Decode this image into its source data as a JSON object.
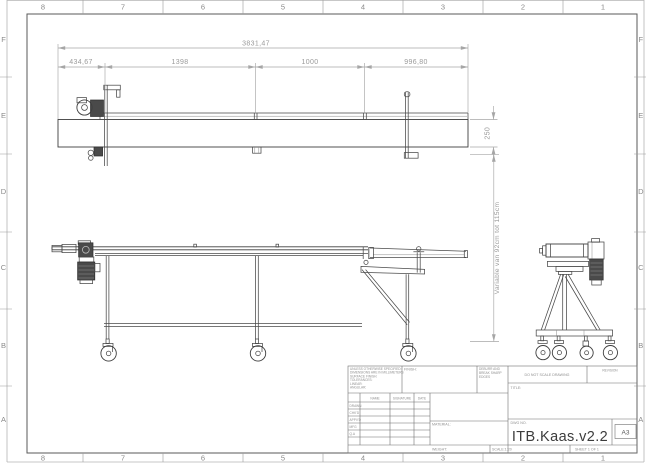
{
  "sheet": {
    "paper_size": "A3"
  },
  "grid": {
    "cols": [
      "8",
      "7",
      "6",
      "5",
      "4",
      "3",
      "2",
      "1"
    ],
    "rows": [
      "F",
      "E",
      "D",
      "C",
      "B",
      "A"
    ]
  },
  "dimensions": {
    "overall_length": "3831,47",
    "segment_1": "434,67",
    "segment_2": "1398",
    "segment_3": "1000",
    "segment_4": "996,80",
    "belt_section_height": "250",
    "height_note": "Variable van 92cm tot 115cm"
  },
  "title_block": {
    "tolerance_note_lines": [
      "UNLESS OTHERWISE SPECIFIED:",
      "DIMENSIONS ARE IN MILLIMETERS",
      "SURFACE FINISH:",
      "TOLERANCES:",
      "   LINEAR:",
      "   ANGULAR:"
    ],
    "finish_label": "FINISH:",
    "deburr_note_lines": [
      "DEBURR AND",
      "BREAK SHARP",
      "EDGES"
    ],
    "do_not_scale_note": "DO NOT SCALE DRAWING",
    "revision_label": "REVISION",
    "signoff_columns": [
      "NAME",
      "SIGNATURE",
      "DATE"
    ],
    "signoff_rows": [
      "DRAWN",
      "CHK'D",
      "APPV'D",
      "MFG",
      "Q.A"
    ],
    "material_label": "MATERIAL:",
    "weight_label": "WEIGHT:",
    "title_label": "TITLE:",
    "dwg_no_label": "DWG NO.",
    "drawing_number": "ITB.Kaas.v2.2",
    "paper_size": "A3",
    "scale_label": "SCALE:1:20",
    "sheet_label": "SHEET 1 OF 1"
  }
}
